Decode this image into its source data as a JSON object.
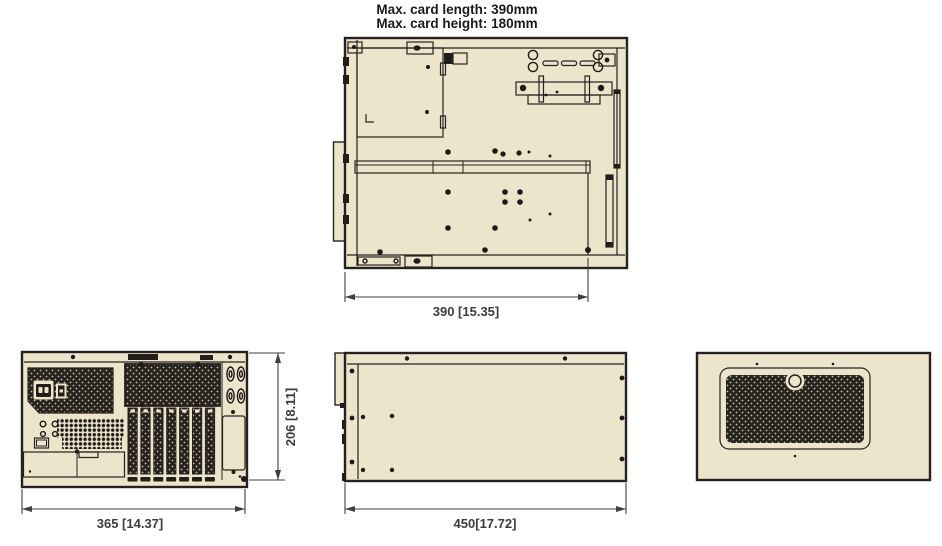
{
  "title": {
    "line1": "Max. card length: 390mm",
    "line2": "Max. card height: 180mm"
  },
  "dimensions": {
    "top_view_width": "390 [15.35]",
    "front_view_width": "365 [14.37]",
    "front_view_height": "206 [8.11]",
    "side_view_length": "450[17.72]"
  },
  "colors": {
    "background": "#FFFFFF",
    "chassis_fill": "#EDE4CC",
    "outline": "#262220",
    "dark_fill": "#221E1A",
    "dimension_text": "#3C3C3C"
  }
}
